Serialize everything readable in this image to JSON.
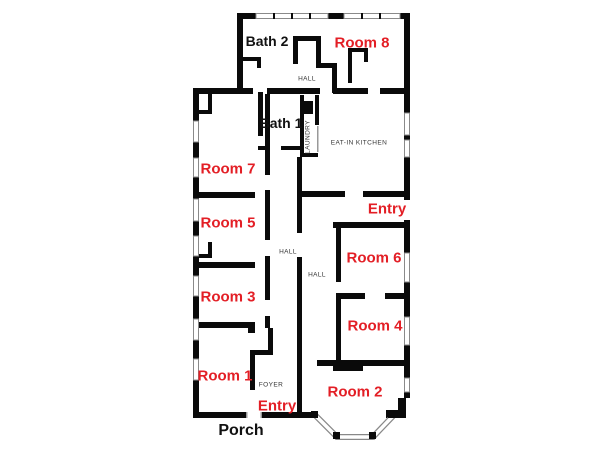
{
  "figure": "residential floor plan",
  "colors": {
    "wall": "#0a0a0a",
    "room_label": "#e31e25",
    "black_label": "#111111",
    "small_label": "#333333",
    "window_stroke": "#8a8a8a",
    "background": "#ffffff"
  },
  "labels": {
    "room1": "Room 1",
    "room2": "Room 2",
    "room3": "Room 3",
    "room4": "Room 4",
    "room5": "Room 5",
    "room6": "Room 6",
    "room7": "Room 7",
    "room8": "Room 8",
    "bath1": "Bath 1",
    "bath2": "Bath 2",
    "entry_side": "Entry",
    "entry_front": "Entry",
    "porch": "Porch",
    "foyer": "FOYER",
    "hall_upper": "HALL",
    "hall_left": "HALL",
    "hall_right": "HALL",
    "kitchen": "EAT-IN KITCHEN",
    "laundry": "LAUNDRY"
  }
}
